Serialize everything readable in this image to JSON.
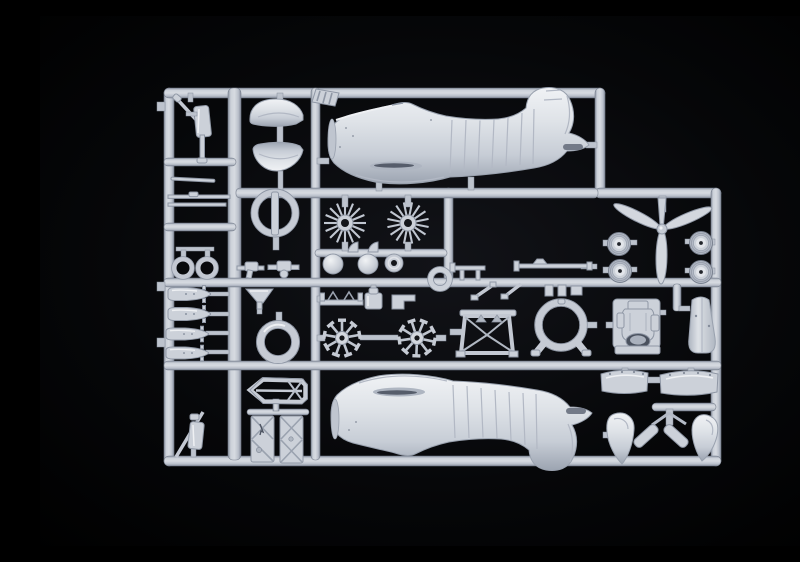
{
  "scene": {
    "type": "photograph",
    "subject": "Plastic scale-model kit sprue with light grey aircraft parts on a black background",
    "background_description": "black studio backdrop with faint centre glow",
    "plastic_finish": "matte light grey-blue styrene"
  },
  "colors": {
    "background": "#000000",
    "glow": "#17181d",
    "plastic_base": "#ccd1d9",
    "plastic_light": "#eef0f3",
    "plastic_shade": "#aab1bd",
    "plastic_edge": "#8f97a5",
    "plastic_deep": "#5f6673",
    "hole_dark": "#14161a",
    "runner_hi": "#d7dbe1",
    "runner_lo": "#8a92a0"
  },
  "sprue": {
    "shape": "rounded rectangular runner frame with stepped top-right corner and internal runners",
    "parts_inventory": [
      {
        "id": "fuselage-half",
        "quantity": 2,
        "note": "one upright (fin up), one flipped (fin down)"
      },
      {
        "id": "engine-cowling-half",
        "quantity": 2
      },
      {
        "id": "cowl-ring-with-axle",
        "quantity": 1
      },
      {
        "id": "cylinder-row-sunburst",
        "quantity": 2
      },
      {
        "id": "crankcase-dome",
        "quantity": 2
      },
      {
        "id": "hub-disc",
        "quantity": 1
      },
      {
        "id": "retaining-ring",
        "quantity": 1
      },
      {
        "id": "three-blade-propeller",
        "quantity": 1
      },
      {
        "id": "main-wheel",
        "quantity": 4
      },
      {
        "id": "radial-engine-cylinder-star",
        "quantity": 2
      },
      {
        "id": "cowl-front-ring",
        "quantity": 1
      },
      {
        "id": "exhaust-funnel",
        "quantity": 1
      },
      {
        "id": "boarding-step-bracket",
        "quantity": 1
      },
      {
        "id": "oil-tank-canister",
        "quantity": 1
      },
      {
        "id": "angle-bracket",
        "quantity": 1
      },
      {
        "id": "canopy-sled-frame",
        "quantity": 1
      },
      {
        "id": "braced-hatch-panel",
        "quantity": 2
      },
      {
        "id": "engine-mount-truss",
        "quantity": 1
      },
      {
        "id": "exhaust-collector-ring-with-legs",
        "quantity": 1
      },
      {
        "id": "engine-gearbox-block",
        "quantity": 1
      },
      {
        "id": "cowling-cone",
        "quantity": 1
      },
      {
        "id": "cowl-flap-band",
        "quantity": 2
      },
      {
        "id": "wheel-spat-fairing",
        "quantity": 2
      },
      {
        "id": "spat-leg-strap",
        "quantity": 2
      },
      {
        "id": "bomb",
        "quantity": 4
      },
      {
        "id": "landing-gear-oleo-strut",
        "quantity": 2
      },
      {
        "id": "small-ring",
        "quantity": 2
      },
      {
        "id": "thin-strut-rod",
        "quantity": 2
      },
      {
        "id": "machine-gun",
        "quantity": 3
      },
      {
        "id": "antenna-mast-rod",
        "quantity": 1
      },
      {
        "id": "v-brace",
        "quantity": 2
      },
      {
        "id": "small-fitting",
        "quantity": 3
      },
      {
        "id": "fin-tab",
        "quantity": 2
      },
      {
        "id": "hatched-sprue-tab",
        "quantity": 1
      }
    ]
  }
}
